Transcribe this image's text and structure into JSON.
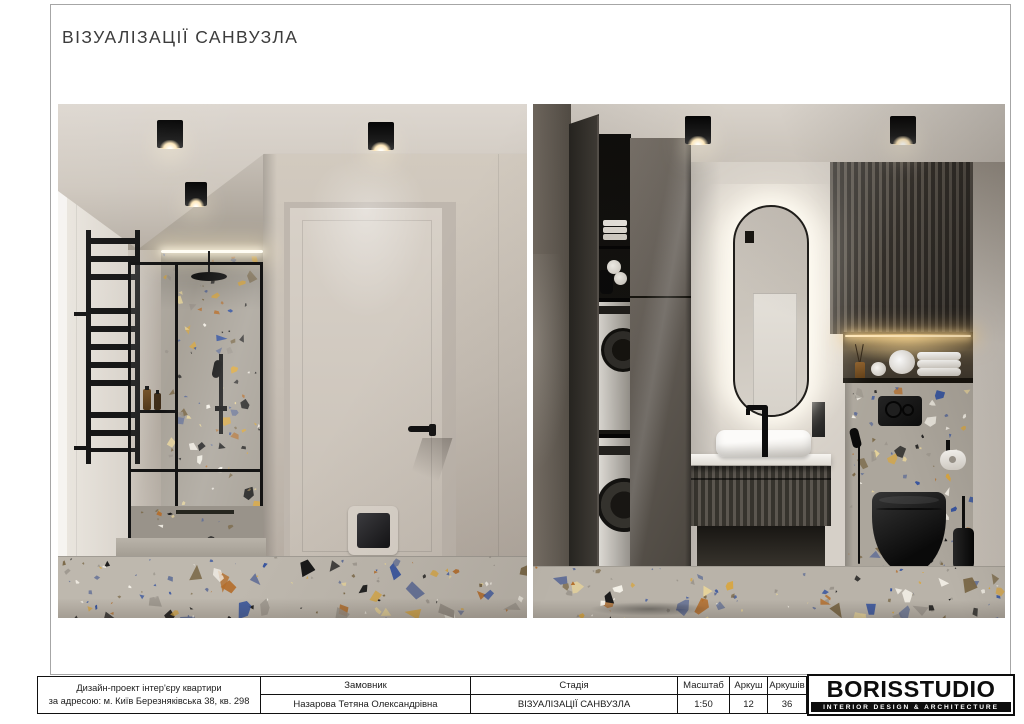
{
  "page": {
    "title": "ВІЗУАЛІЗАЦІЇ САНВУЗЛА"
  },
  "footer": {
    "project": {
      "line1": "Дизайн-проект інтер'єру квартири",
      "line2": "за адресою: м. Київ Березняківська 38, кв. 298"
    },
    "cells": [
      {
        "label": "Замовник",
        "value": "Назарова Тетяна Олександрівна"
      },
      {
        "label": "Стадія",
        "value": "ВІЗУАЛІЗАЦІЇ САНВУЗЛА"
      },
      {
        "label": "Масштаб",
        "value": "1:50"
      },
      {
        "label": "Аркуш",
        "value": "12"
      },
      {
        "label": "Аркушів",
        "value": "36"
      }
    ],
    "logo": {
      "name": "BORISSTUDIO",
      "tagline": "INTERIOR DESIGN & ARCHITECTURE"
    }
  },
  "colors": {
    "terrazzo": [
      "#35539e",
      "#d8a63f",
      "#b46e2c",
      "#191919",
      "#f6f2e9",
      "#e7d49a",
      "#5f6d96",
      "#7c6a4a",
      "#9a948b"
    ],
    "accent_black": "#111111",
    "page_border": "#a6a6a6",
    "table_border": "#111111",
    "logo_bg": "#0d0d0d"
  }
}
